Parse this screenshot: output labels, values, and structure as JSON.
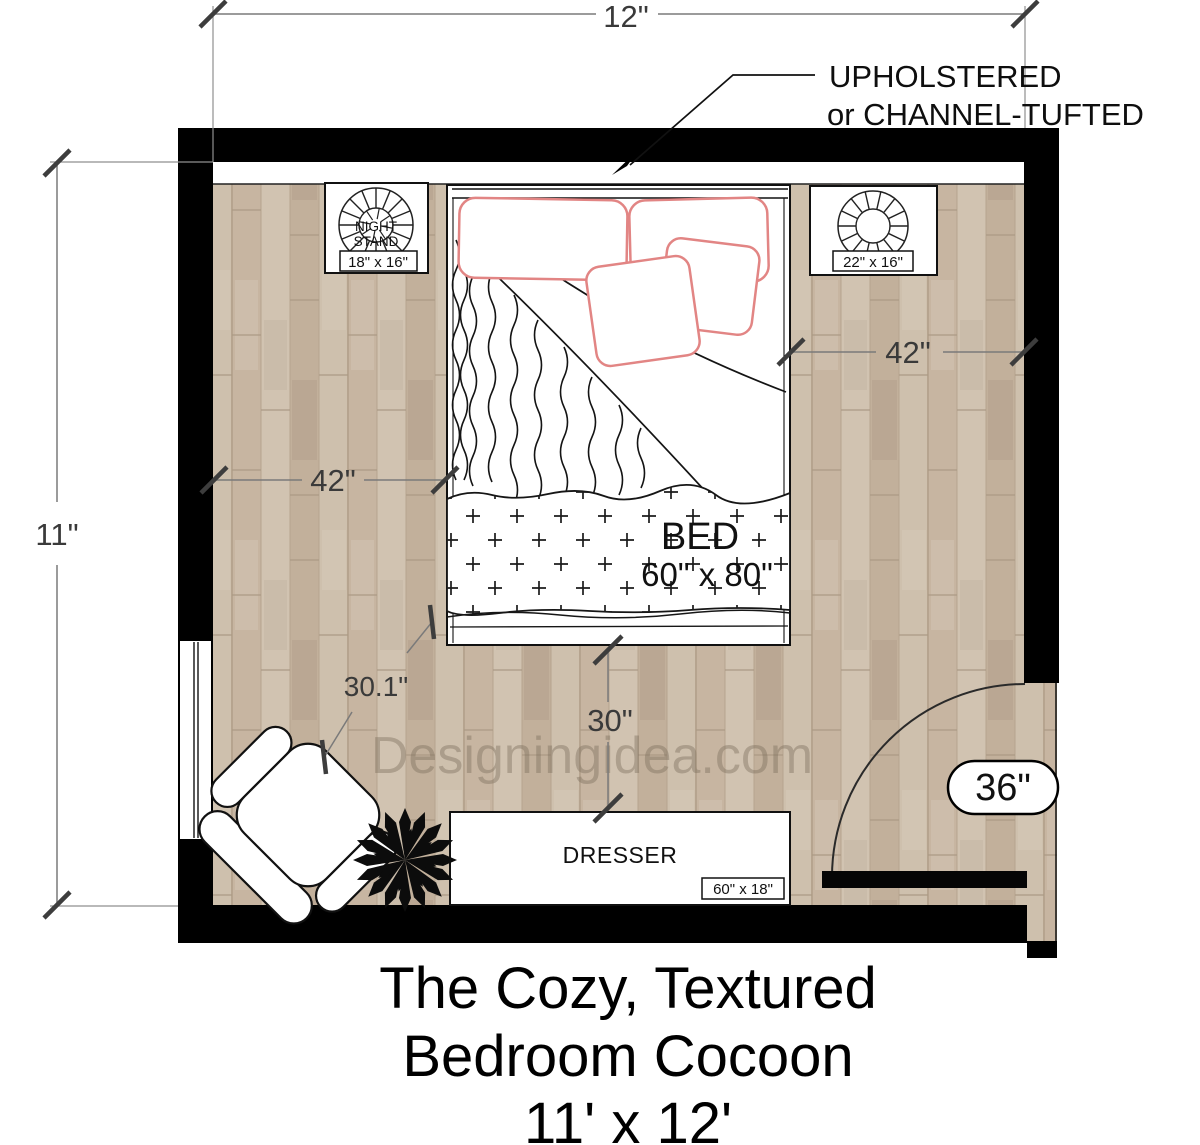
{
  "plan": {
    "watermark": "Designingidea.com",
    "title_line1": "The Cozy, Textured",
    "title_line2": "Bedroom Cocoon",
    "title_line3": "11' x 12'"
  },
  "dims": {
    "room_width": "12\"",
    "room_height": "11\"",
    "bed_left_clearance": "42\"",
    "bed_right_clearance": "42\"",
    "chair_clearance": "30.1\"",
    "dresser_clearance": "30\"",
    "door_width": "36\""
  },
  "note": {
    "line1": "UPHOLSTERED",
    "line2": "or CHANNEL-TUFTED"
  },
  "furniture": {
    "bed": {
      "label": "BED",
      "size": "60\" x 80\""
    },
    "nightstand_left": {
      "line1": "NIGHT",
      "line2": "STAND",
      "size": "18\" x 16\""
    },
    "nightstand_right": {
      "size": "22\" x 16\""
    },
    "dresser": {
      "label": "DRESSER",
      "size": "60\" x 18\""
    }
  },
  "colors": {
    "wall": "#000000",
    "floor_base": "#cbbba8",
    "pillow_outline": "#e28584",
    "dimension_text": "#3a3a3a"
  }
}
